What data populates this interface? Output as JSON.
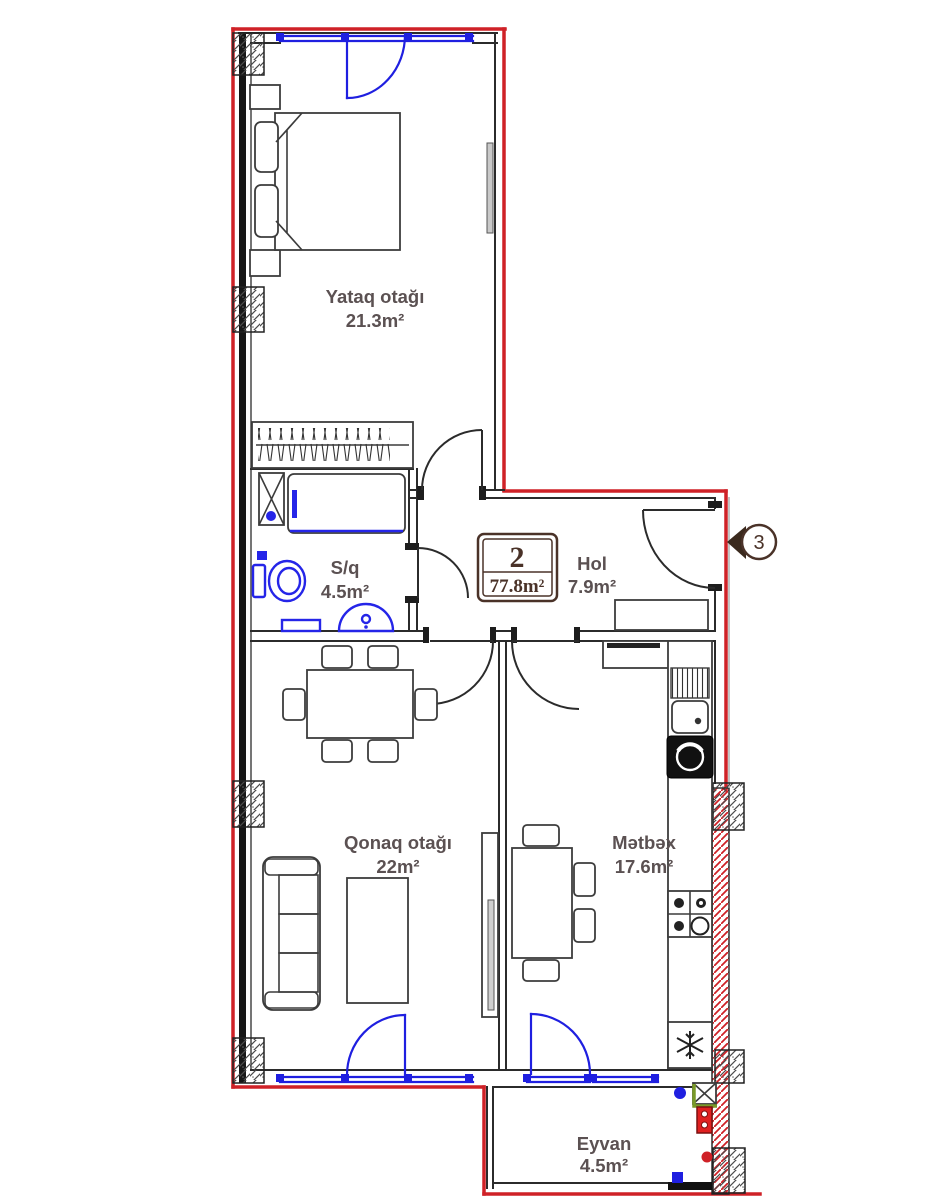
{
  "plan": {
    "badge": {
      "number": "2",
      "total_area": "77.8m²"
    },
    "entrance": {
      "marker": "3"
    },
    "rooms": {
      "bedroom": {
        "name": "Yataq otağı",
        "area": "21.3m²"
      },
      "bathroom": {
        "name": "S/q",
        "area": "4.5m²"
      },
      "hall": {
        "name": "Hol",
        "area": "7.9m²"
      },
      "living": {
        "name": "Qonaq otağı",
        "area": "22m²"
      },
      "kitchen": {
        "name": "Mətbəx",
        "area": "17.6m²"
      },
      "balcony": {
        "name": "Eyvan",
        "area": "4.5m²"
      }
    },
    "colors": {
      "exterior_wall": "#cf2127",
      "window": "#1f1fe0",
      "sanitary": "#2525e8",
      "room_label": "#5b5152",
      "badge": "#4a3228"
    }
  }
}
